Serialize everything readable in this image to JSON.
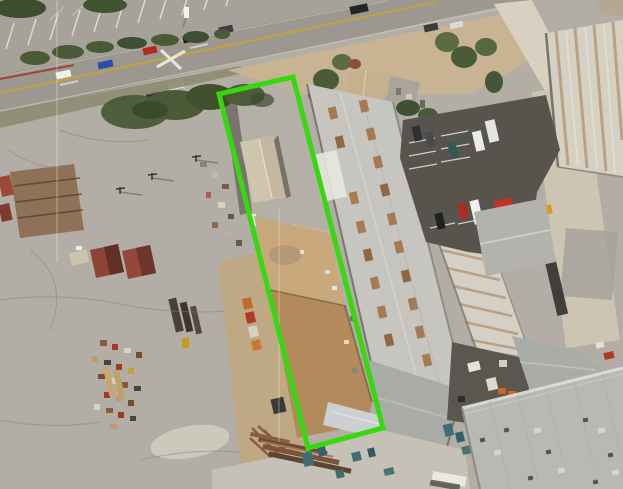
{
  "meta": {
    "type": "aerial-photo-with-annotation",
    "description": "Oblique-free orthographic aerial photo of an industrial block; a narrow rotated rectangular parcel is outlined in bright green.",
    "width_px": 623,
    "height_px": 489
  },
  "parcel_highlight": {
    "points": "219,94 293,77 383,428 308,448",
    "corners": [
      [
        219,
        94
      ],
      [
        293,
        77
      ],
      [
        383,
        428
      ],
      [
        308,
        448
      ]
    ],
    "stroke": "#35d90e",
    "stroke_width": 5
  },
  "palette": {
    "ground": "#b2ada5",
    "north_lot": "#a6a29a",
    "road": "#9c978f",
    "road_center_line": "#c7a23c",
    "grass_strip": "#8d8c70",
    "dirt_tan": "#c8b493",
    "driveway": "#d8d1c1",
    "alley_tan": "#cdc4b2",
    "parking_lot_dark": "#57544d",
    "roof_light_gray": "#c7c5c0",
    "roof_tan_light": "#c9a87c",
    "roof_tan": "#b28a5c",
    "roof_white_rust": "#d5d0c3",
    "rust_streak": "#a87a52",
    "roof_warehouse": "#b6b9b4",
    "roof_silver": "#ccd0d0",
    "tent_red": "#8c4436",
    "tree_green": "#4a5a36",
    "concrete_light": "#c6c1b6",
    "dark_yard": "#5a5750"
  }
}
